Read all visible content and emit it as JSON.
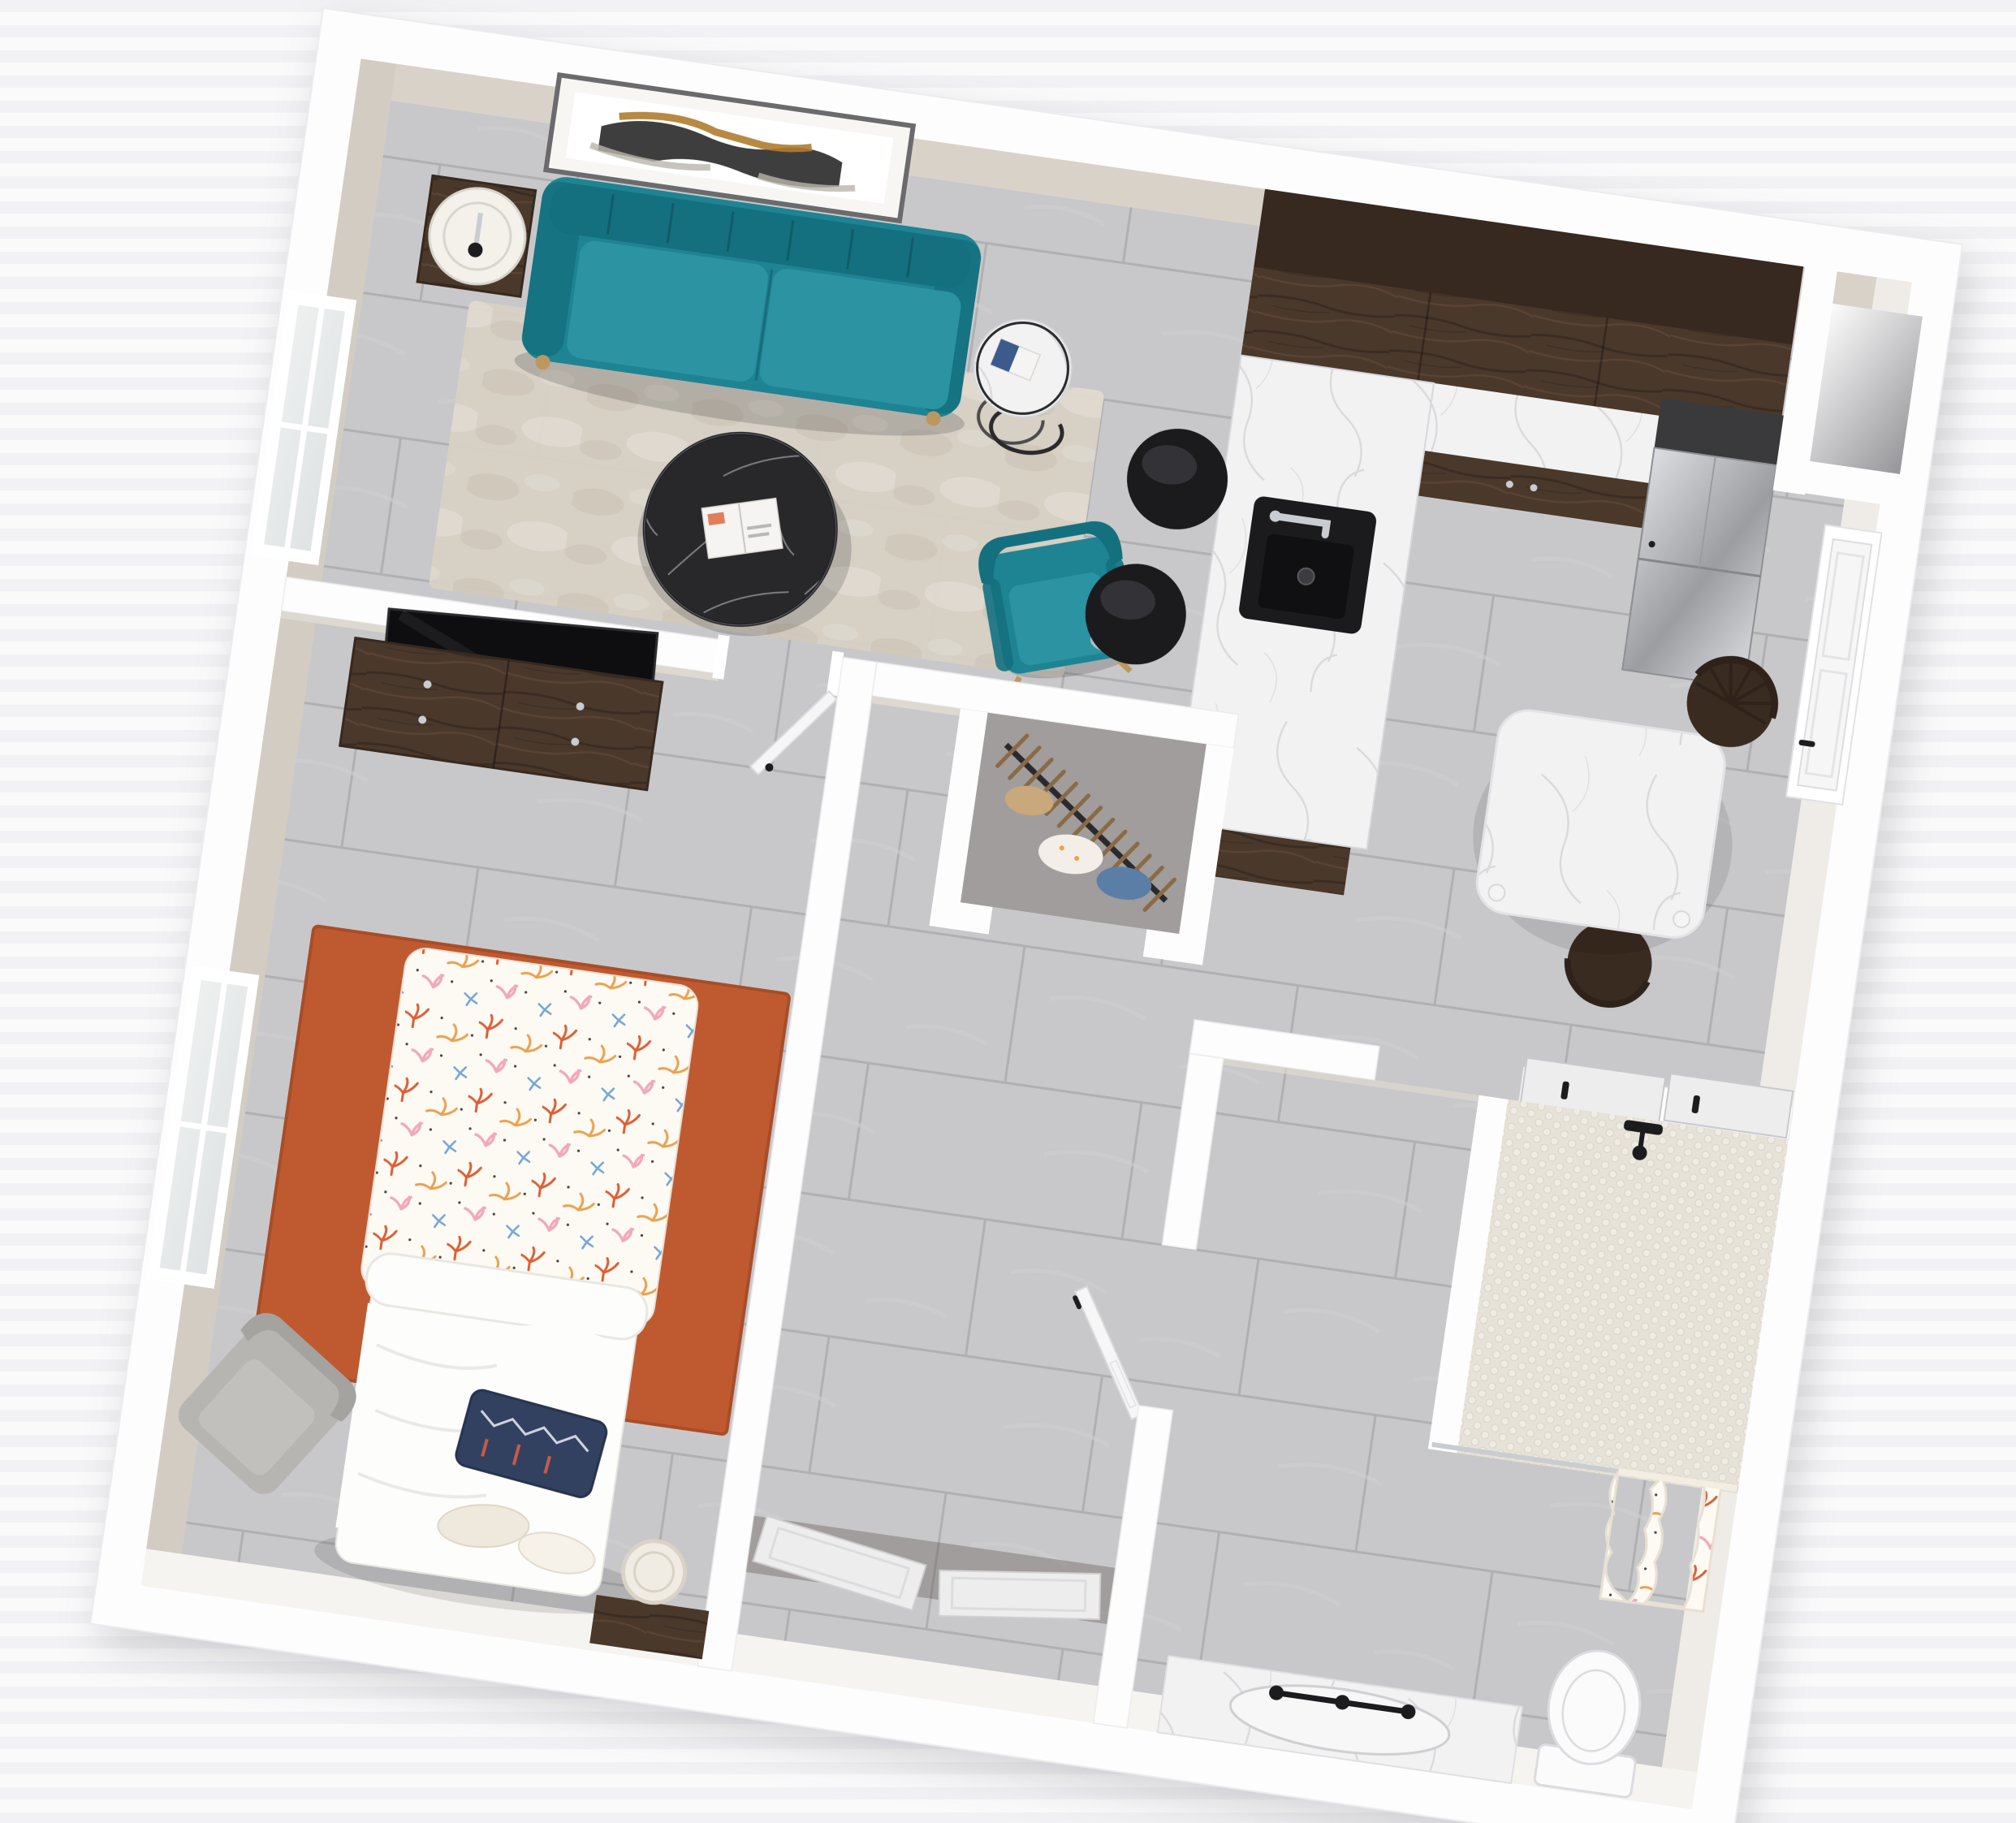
{
  "scene": {
    "kind": "3d-floor-plan-render",
    "view": "top-down dollhouse view, plan rotated about 8 degrees",
    "unit": "one-bedroom apartment"
  },
  "palette": {
    "wall": "#fdfdfe",
    "wall_edge": "#ececee",
    "wall_face_top": "#d8d2c9",
    "wall_face_left": "#d2ccc3",
    "wall_face_right": "#efece7",
    "wall_face_bottom": "#f6f4f1",
    "wall_face_inner": "#ddd8d0",
    "tile": "#c8c8ca",
    "tile_alt": "#cfcfd1",
    "tile_grout": "#b0b0b3",
    "rug_living": "#d7d0c5",
    "rug_living_mottle": "#c9c0b1",
    "rug_living_light": "#e4dfd5",
    "rug_bedroom": "#bf5a30",
    "rug_bedroom_edge": "#a84d28",
    "sofa": "#1e8493",
    "sofa_dark": "#14707f",
    "sofa_light": "#2b93a2",
    "espresso": "#4a382b",
    "espresso_dark": "#37291f",
    "espresso_streak": "#5c4634",
    "marble": "#f2f2f3",
    "marble_vein": "#d7d8db",
    "black_marble": "#28282b",
    "black_marble_vein": "#97979c",
    "counter_black": "#3a3a3d",
    "sink_black": "#1b1b1d",
    "sink_basin": "#101012",
    "chrome": "#c9ccd0",
    "stainless_light": "#dcdde0",
    "stainless_dark": "#9b9da1",
    "door_white": "#f6f6f7",
    "door_panel": "#ededee",
    "door_frame": "#ffffff",
    "handle_black": "#1c1c1e",
    "glass": "#dfe3e3",
    "mullion": "#ffffff",
    "penny_bg": "#e6e2d8",
    "penny_dot": "#efece4",
    "penny_stroke": "#d8d4c8",
    "coral_bg": "#fdfaf4",
    "coral_red": "#dd5f35",
    "coral_orange": "#eca14f",
    "coral_pink": "#f0a9bb",
    "coral_blue": "#74a7d4",
    "coral_dark": "#45464a",
    "blanket_white": "#fdfdfc",
    "blanket_shade": "#e9e7e2",
    "navy": "#31415f",
    "navy_trim": "#c75b4a",
    "navy_light": "#cfd6e2",
    "lamp": "#f3f1ea",
    "lamp_ring": "#d8d5cd",
    "gray_chair": "#b7b5b2",
    "gray_chair_dark": "#a5a3a0",
    "niche_light": "#fbfbfb",
    "niche_dark": "#96969a",
    "basket": "#f0ece4",
    "basket_line": "#d9d3c7",
    "wood_foot": "#bd9760",
    "chair_wood": "#3a2b20",
    "chair_wood_dark": "#2f221a",
    "art_frame": "#6b6b6e",
    "art_mat": "#f7f6f3",
    "art_black": "#232324",
    "art_gold": "#b07c2e",
    "art_gray": "#b9b5aa",
    "shadow": "rgba(0,0,0,0.16)",
    "closet_shade": "rgba(70,60,50,0.30)",
    "hanger_wood": "#8a6a45",
    "rack_black": "#2a2a2c",
    "magazine_white": "#f5f4f2",
    "magazine_blue": "#3c5a8c",
    "toilet_white": "#fbfbfc",
    "toilet_line": "#dcdce0"
  },
  "counts": {
    "closet_hangers": 13,
    "chair_spindles": 7,
    "sofa_channels": 6
  },
  "rooms": {
    "living_room": {
      "items": [
        "abstract-wall-art",
        "teal-sofa",
        "table-lamp",
        "lamp-side-table",
        "round-side-table",
        "area-rug",
        "black-marble-coffee-table",
        "open-magazine",
        "teal-accent-chair",
        "window"
      ]
    },
    "kitchen": {
      "items": [
        "upper-cabinets",
        "l-shaped-counter",
        "black-sink",
        "faucet",
        "bar-stool",
        "bar-stool",
        "refrigerator",
        "black-counter",
        "corner-niche",
        "entry-door"
      ]
    },
    "dining": {
      "items": [
        "marble-dining-table",
        "windsor-chair",
        "windsor-chair"
      ]
    },
    "bedroom": {
      "items": [
        "dresser",
        "tv",
        "bed",
        "coral-duvet",
        "white-blanket",
        "navy-pillow",
        "foot-pillows",
        "orange-rug",
        "gray-armchair",
        "laundry-basket",
        "foot-bench",
        "window",
        "bedroom-door"
      ]
    },
    "closet": {
      "items": [
        "clothes-rack",
        "hangers",
        "clothes"
      ]
    },
    "hall": {
      "items": [
        "hall-door",
        "bifold-closet-doors"
      ]
    },
    "bathroom": {
      "items": [
        "sliding-pocket-doors",
        "shower",
        "penny-tile-floor",
        "shower-curtain",
        "curtain-rod",
        "shower-head",
        "vanity",
        "vanity-faucet",
        "toilet"
      ]
    }
  }
}
